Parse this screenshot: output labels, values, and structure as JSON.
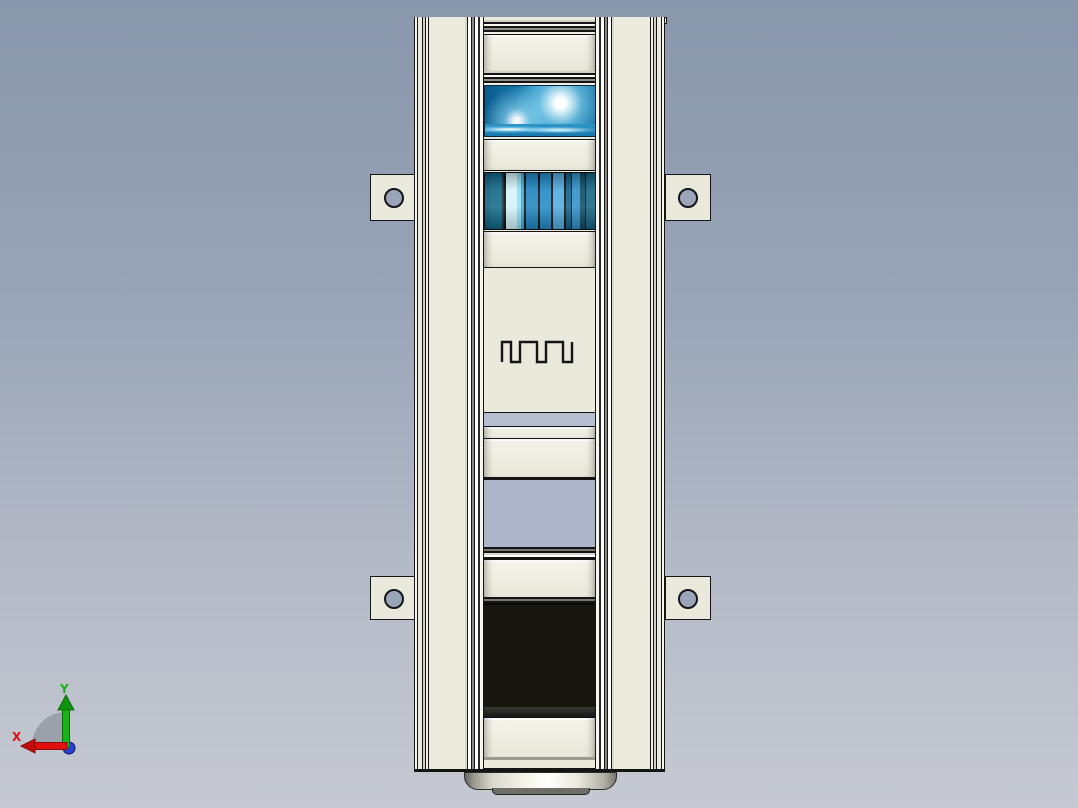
{
  "viewport": {
    "background_top": "#8997AC",
    "background_bottom": "#C6C9D2"
  },
  "axis_triad": {
    "x_label": "X",
    "y_label": "Y",
    "x_color": "#E01010",
    "y_color": "#18B418",
    "z_dot_color": "#2B3FD0",
    "sector_color": "#9AA1AB"
  },
  "model": {
    "frame_color": "#EAEADD",
    "outline_color": "#141414",
    "parts": [
      {
        "name": "top-cover-panel",
        "color": "#1B86BA"
      },
      {
        "name": "finned-motor-body",
        "color": "#2189C4"
      },
      {
        "name": "pulley-disc",
        "color": "#2E93C6"
      },
      {
        "name": "jaw-coupling",
        "color": "#E8E8E0"
      },
      {
        "name": "mount-plate-with-holes",
        "color": "#E9E9DC"
      },
      {
        "name": "tapered-hub",
        "color": "#EFEFE7"
      },
      {
        "name": "clamp-unit",
        "color": "#F7F7F1"
      },
      {
        "name": "base-cap",
        "color": "#D8D8CC"
      }
    ],
    "mounting_tab_color": "#E9E9DC",
    "tab_hole_color": "#9AA5B9"
  }
}
